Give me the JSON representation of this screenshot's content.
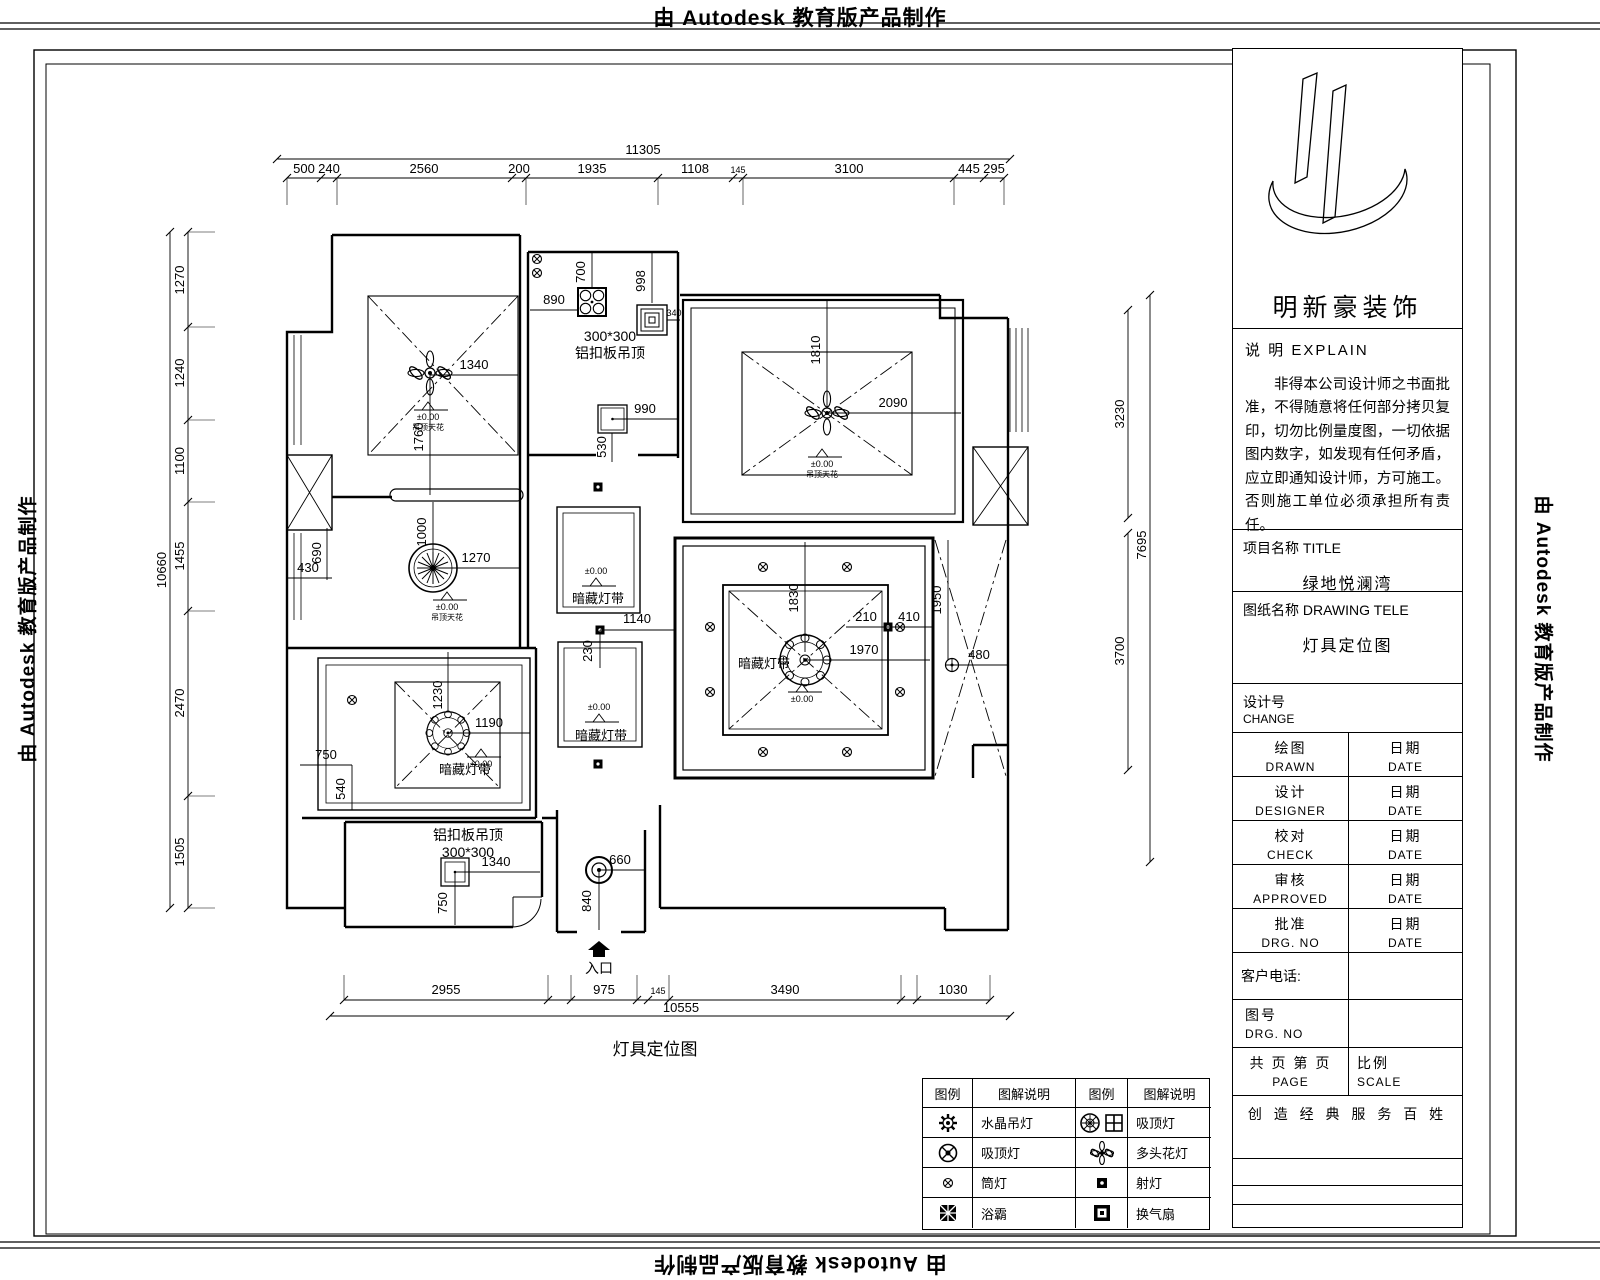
{
  "banner": {
    "text": "由 Autodesk 教育版产品制作"
  },
  "plan": {
    "caption": "灯具定位图",
    "entrance": "入口"
  },
  "elev": {
    "v": "±0.00",
    "n": "吊顶天花"
  },
  "labels": {
    "kitchen1": "300*300",
    "kitchen2": "铝扣板吊顶",
    "bath1": "铝扣板吊顶",
    "bath2": "300*300",
    "strip": "暗藏灯带"
  },
  "dims": {
    "top": {
      "total": "11305",
      "segs": [
        "500",
        "240",
        "2560",
        "200",
        "1935",
        "1108",
        "145",
        "3100",
        "445",
        "295"
      ]
    },
    "left": {
      "total": "10660",
      "segs": [
        "1270",
        "1240",
        "1100",
        "1455",
        "2470",
        "1505"
      ]
    },
    "right": {
      "total": "7695",
      "segs": [
        "3230",
        "3700"
      ]
    },
    "bottom": {
      "total": "10555",
      "segs": [
        "2955",
        "975",
        "145",
        "3490",
        "1030"
      ]
    },
    "bd1": {
      "a": "1340",
      "b": "1760"
    },
    "kitchen": {
      "a": "890",
      "b": "700",
      "c": "998",
      "d": "340",
      "e": "990",
      "f": "530"
    },
    "ll": {
      "a": "1000",
      "b": "1270",
      "c": "690",
      "d": "430"
    },
    "bd2": {
      "a": "1230",
      "b": "1190",
      "c": "750",
      "d": "540"
    },
    "hall": {
      "a": "1140",
      "b": "230"
    },
    "master": {
      "a": "1810",
      "b": "2090"
    },
    "living": {
      "a": "1830",
      "b": "210",
      "c": "410",
      "d": "1970"
    },
    "bath": {
      "a": "1950",
      "b": "480"
    },
    "entry": {
      "a": "660",
      "b": "840"
    },
    "wc": {
      "a": "1340",
      "b": "750"
    }
  },
  "legend": {
    "headers": [
      "图例",
      "图解说明",
      "图例",
      "图解说明"
    ],
    "rows": [
      {
        "l": "水晶吊灯",
        "r": "吸顶灯"
      },
      {
        "l": "吸顶灯",
        "r": "多头花灯"
      },
      {
        "l": "筒灯",
        "r": "射灯"
      },
      {
        "l": "浴霸",
        "r": "换气扇"
      }
    ]
  },
  "tb": {
    "company": "明新豪装饰",
    "explain_label": "说 明 EXPLAIN",
    "explain_text": "非得本公司设计师之书面批准，不得随意将任何部分拷贝复印，切勿比例量度图，一切依据图内数字，如发现有任何矛盾，应立即通知设计师，方可施工。否则施工单位必须承担所有责任。",
    "project_label": "项目名称 TITLE",
    "project_value": "绿地悦澜湾",
    "drawing_label": "图纸名称 DRAWING  TELE",
    "drawing_value": "灯具定位图",
    "design_no_cn": "设计号",
    "design_no_en": "CHANGE",
    "rows": [
      {
        "cn": "绘图",
        "en": "DRAWN",
        "dcn": "日期",
        "den": "DATE"
      },
      {
        "cn": "设计",
        "en": "DESIGNER",
        "dcn": "日期",
        "den": "DATE"
      },
      {
        "cn": "校对",
        "en": "CHECK",
        "dcn": "日期",
        "den": "DATE"
      },
      {
        "cn": "审核",
        "en": "APPROVED",
        "dcn": "日期",
        "den": "DATE"
      },
      {
        "cn": "批准",
        "en": "DRG. NO",
        "dcn": "日期",
        "den": "DATE"
      }
    ],
    "phone_label": "客户电话:",
    "fig_cn": "图号",
    "fig_en": "DRG. NO",
    "page_cn": "共 页   第 页",
    "page_en": "PAGE",
    "scale_cn": "比例",
    "scale_en": "SCALE",
    "slogan": "创 造 经 典   服 务 百 姓"
  }
}
